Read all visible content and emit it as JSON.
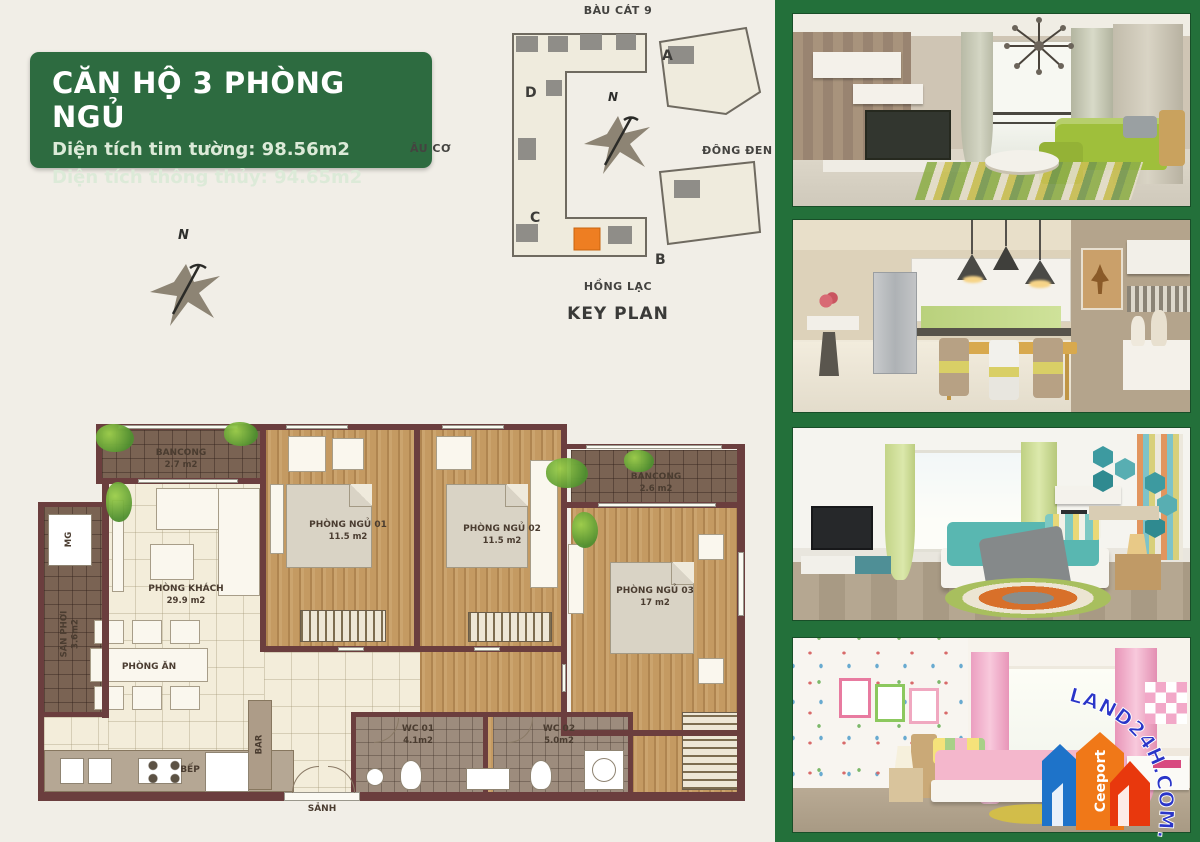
{
  "title_box": {
    "title": "CĂN HỘ 3 PHÒNG NGỦ",
    "line1": "Diện tích tim tường: 98.56m2",
    "line2": "Diện tích thông thủy: 94.65m2"
  },
  "key_plan": {
    "street_top": "BÀU CÁT 9",
    "street_left": "ÂU CƠ",
    "street_right": "ĐÔNG ĐEN",
    "street_bottom": "HỒNG LẠC",
    "caption": "KEY PLAN",
    "block_a": "A",
    "block_b": "B",
    "block_c": "C",
    "block_d": "D",
    "north": "N"
  },
  "compass": {
    "north": "N"
  },
  "floor_plan": {
    "rooms": {
      "balcony1": {
        "name": "BANCONG",
        "area": "2.7 m2"
      },
      "bedroom1": {
        "name": "PHÒNG NGỦ 01",
        "area": "11.5 m2"
      },
      "bedroom2": {
        "name": "PHÒNG NGỦ 02",
        "area": "11.5 m2"
      },
      "balcony2": {
        "name": "BANCONG",
        "area": "2.6 m2"
      },
      "living": {
        "name": "PHÒNG KHÁCH",
        "area": "29.9 m2"
      },
      "bedroom3": {
        "name": "PHÒNG NGỦ 03",
        "area": "17 m2"
      },
      "dining": {
        "name": "PHÒNG ĂN"
      },
      "laundry": {
        "name": "SÂN PHƠI",
        "area": "3.6m2"
      },
      "washer": {
        "name": "MG"
      },
      "bar": {
        "name": "BAR"
      },
      "kitchen": {
        "name": "BẾP"
      },
      "hall": {
        "name": "SẢNH"
      },
      "wc1": {
        "name": "WC 01",
        "area": "4.1m2"
      },
      "wc2": {
        "name": "WC 02",
        "area": "5.0m2"
      }
    }
  },
  "watermark": {
    "text": "LAND24H.COM.VN",
    "logo": "Ceeport"
  },
  "colors": {
    "panel_green": "#23703a",
    "title_green": "#2d6b40",
    "highlight_orange": "#ee7e22",
    "wall_maroon": "#6b3e3e"
  }
}
